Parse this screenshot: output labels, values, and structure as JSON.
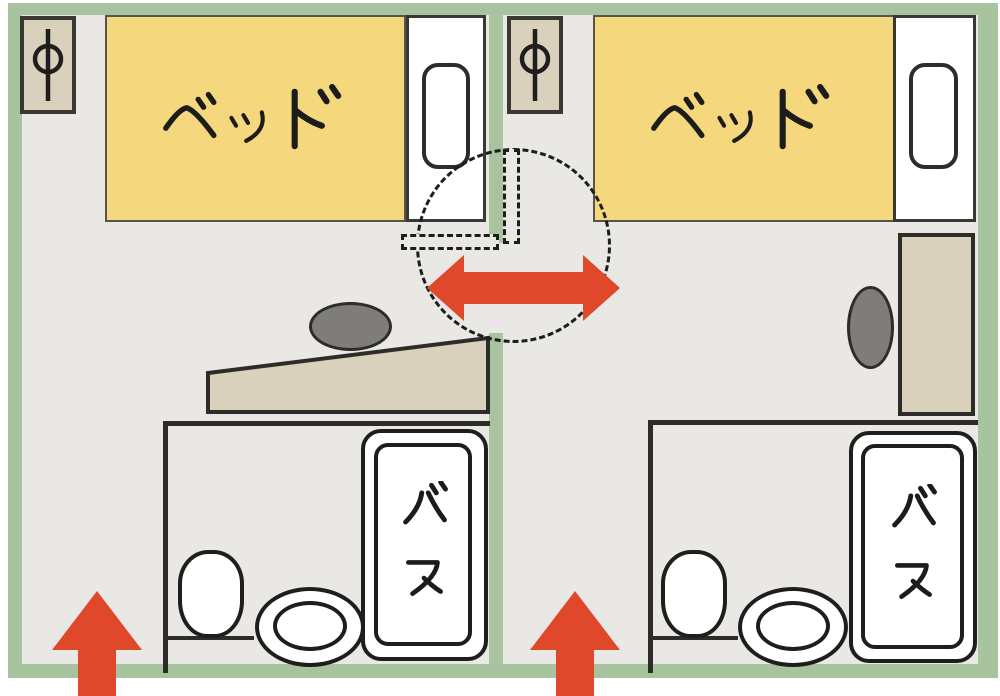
{
  "diagram": {
    "type": "floor-plan",
    "rooms": [
      {
        "id": "left-room",
        "bed_label": "ベッド",
        "bath_label": "バス",
        "lamp_symbol": "φ"
      },
      {
        "id": "right-room",
        "bed_label": "ベッド",
        "bath_label": "バス",
        "lamp_symbol": "φ"
      }
    ],
    "icons": {
      "lamp": "φ",
      "entrance_arrow": "↑",
      "connecting_door_arrow": "↔"
    },
    "colors": {
      "wall_green": "#a8c49e",
      "floor_gray": "#e9e8e5",
      "bed_yellow": "#f5d87d",
      "furniture_tan": "#d9d1bc",
      "chair_gray": "#7e7d7a",
      "outline_dark": "#2d2c29",
      "arrow_red": "#e0482c"
    }
  }
}
